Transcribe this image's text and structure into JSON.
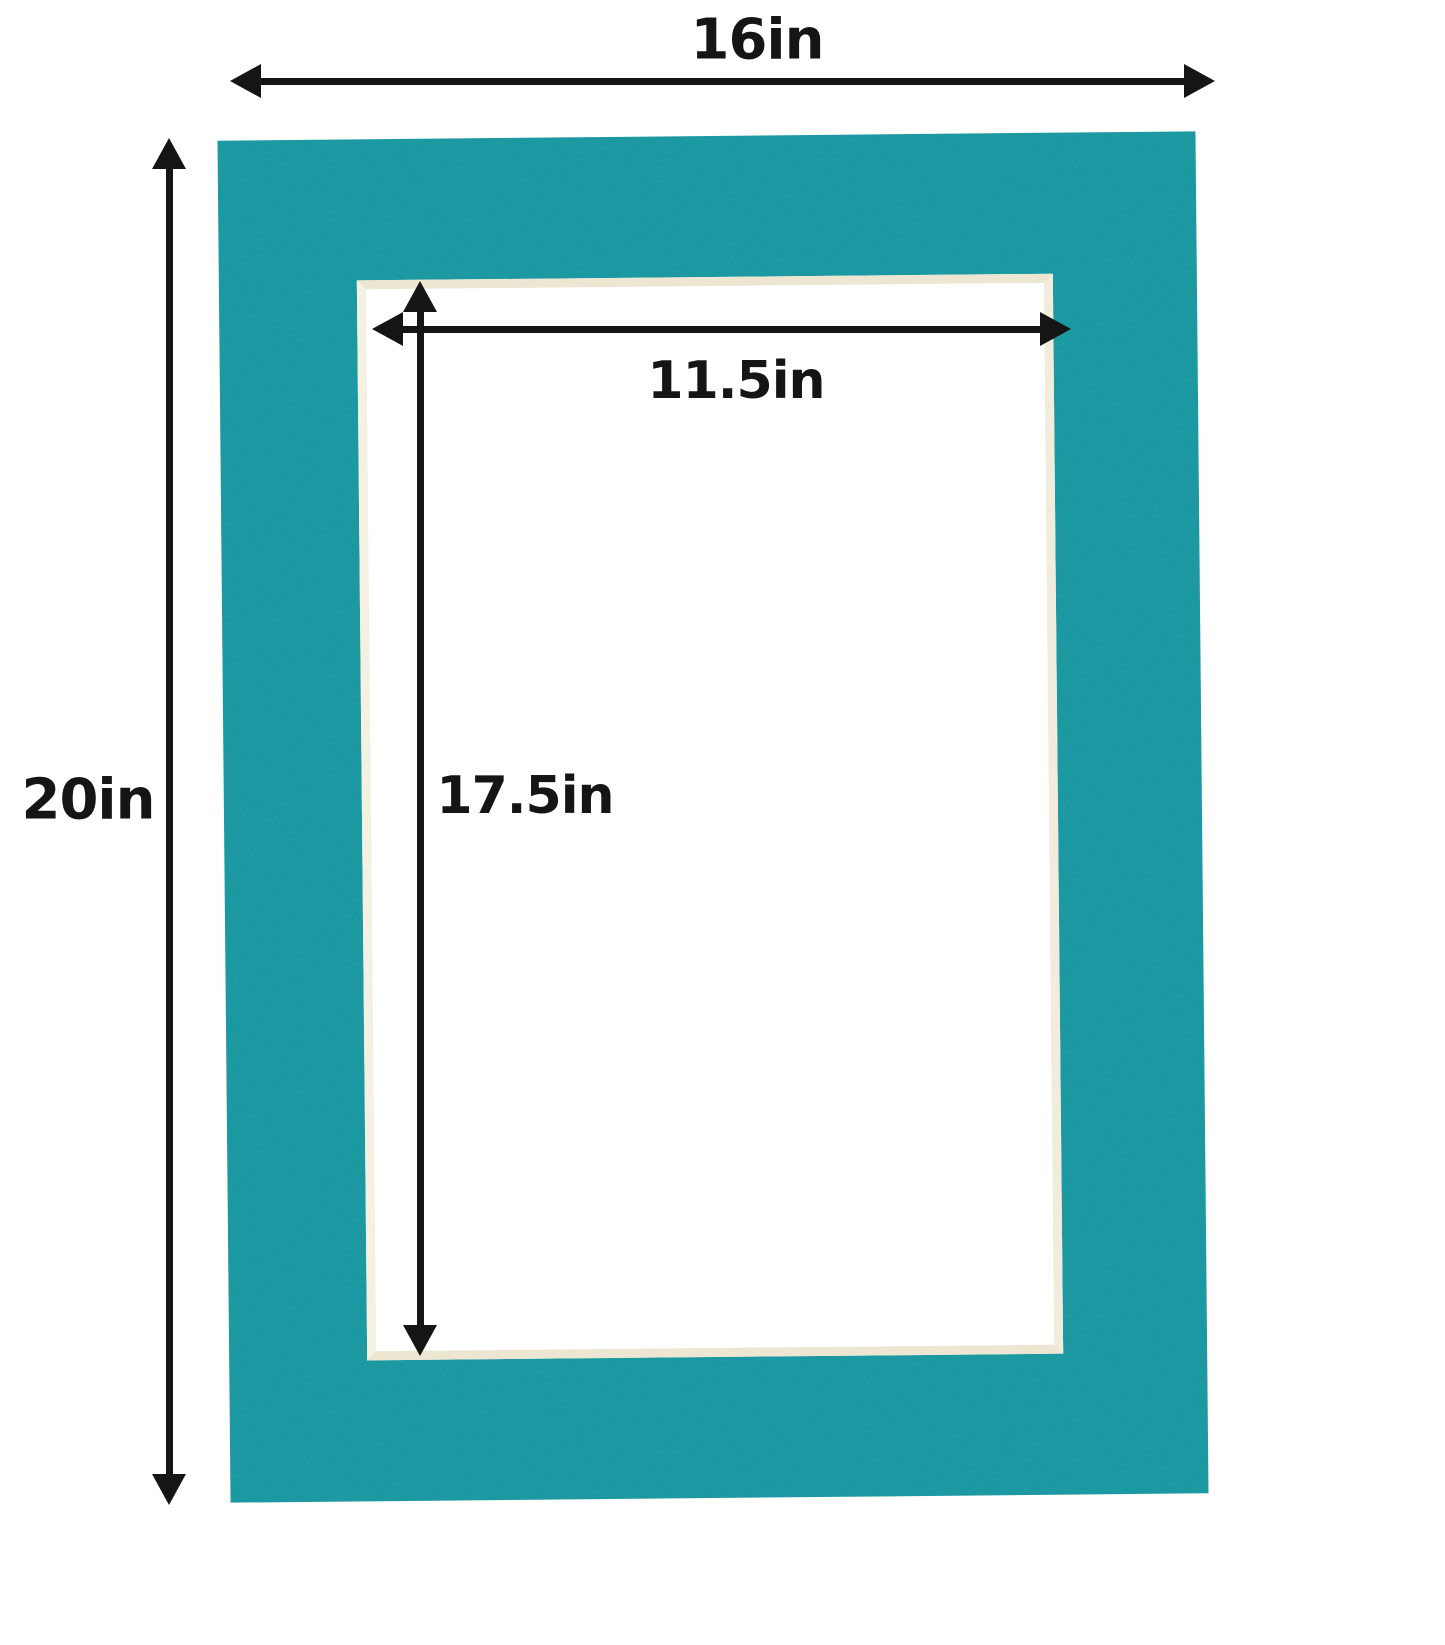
{
  "figure": {
    "type": "picture-mat-dimension-diagram",
    "labels": {
      "outer_width": "16in",
      "outer_height": "20in",
      "opening_width": "11.5in",
      "opening_height": "17.5in"
    },
    "colors": {
      "background": "#ffffff",
      "mat": "#14959e",
      "bevel": "#ece6d3",
      "arrow": "#151515"
    }
  }
}
